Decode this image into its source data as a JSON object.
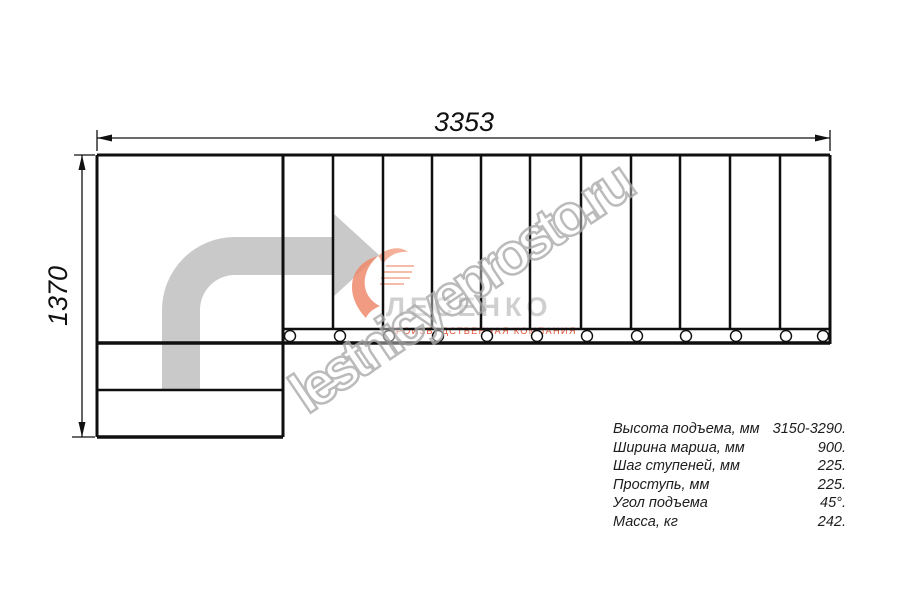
{
  "drawing": {
    "width_label": "3353",
    "height_label": "1370"
  },
  "specs": {
    "rows": [
      {
        "label": "Высота подъема, мм",
        "value": "3150-3290."
      },
      {
        "label": "Ширина марша, мм",
        "value": "900."
      },
      {
        "label": "Шаг ступеней, мм",
        "value": "225."
      },
      {
        "label": "Проступь, мм",
        "value": "225."
      },
      {
        "label": "Угол подъема",
        "value": "45°."
      },
      {
        "label": "Масса, кг",
        "value": "242."
      }
    ]
  },
  "logo": {
    "name": "ЛЕСЕНКО",
    "tagline": "ПРОИЗВОДСТВЕННАЯ КОМПАНИЯ"
  },
  "watermark": {
    "text": "lestnicyeprosto.ru"
  },
  "colors": {
    "line": "#0f0f0f",
    "dimension": "#111111",
    "arrow_fill": "#c9c9c9",
    "logo_accent": "#ef8a6d",
    "logo_accent_light": "#f5b09a",
    "logo_name": "#cfcfcf",
    "tagline": "#e25334",
    "watermark_outline": "#ababab"
  }
}
